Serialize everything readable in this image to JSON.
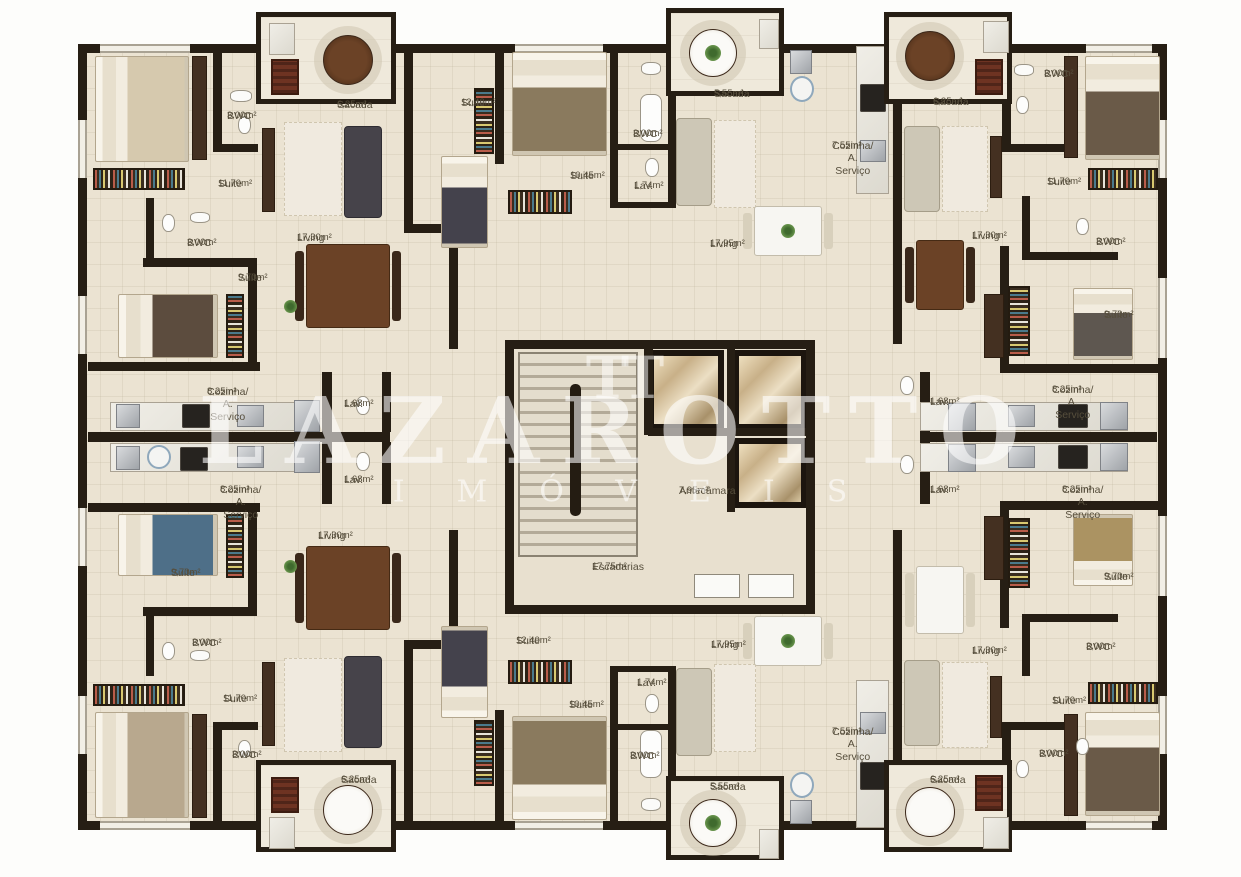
{
  "watermark": {
    "logo": "TT",
    "brand": "LAZAROTTO",
    "sub": "IMÓVEIS"
  },
  "rooms": [
    {
      "label": "BWC",
      "area": "3,00m²"
    },
    {
      "label": "Sacada",
      "area": "6,25m²"
    },
    {
      "label": "Suite",
      "area": "11,70m²"
    },
    {
      "label": "BWC",
      "area": "3,00m²"
    },
    {
      "label": "Suite",
      "area": "9,70m²"
    },
    {
      "label": "Living",
      "area": "17,30m²"
    },
    {
      "label": "Cozinha/ A. Serviço",
      "area": "8,25m²"
    },
    {
      "label": "Lav.",
      "area": "1,68m²"
    },
    {
      "label": "Suite",
      "area": "12,40m²"
    },
    {
      "label": "BWC",
      "area": "3,00m²"
    },
    {
      "label": "Suite",
      "area": "10,45m²"
    },
    {
      "label": "Lav.",
      "area": "1,74m²"
    },
    {
      "label": "Sacada",
      "area": "5,55m²"
    },
    {
      "label": "Living",
      "area": "17,95m²"
    },
    {
      "label": "Cozinha/ A. Serviço",
      "area": "7,55m²"
    },
    {
      "label": "Sacada",
      "area": "6,25m²"
    },
    {
      "label": "BWC",
      "area": "3,00m²"
    },
    {
      "label": "Suite",
      "area": "11,70m²"
    },
    {
      "label": "Living",
      "area": "17,30m²"
    },
    {
      "label": "BWC",
      "area": "3,00m²"
    },
    {
      "label": "Suite",
      "area": "9,70m²"
    },
    {
      "label": "Cozinha/ A. Serviço",
      "area": "8,25m²"
    },
    {
      "label": "Lav.",
      "area": "1,68m²"
    },
    {
      "label": "Cozinha/ A. Serviço",
      "area": "8,25m²"
    },
    {
      "label": "Lav.",
      "area": "1,68m²"
    },
    {
      "label": "Suite",
      "area": "9,70m²"
    },
    {
      "label": "Living",
      "area": "17,30m²"
    },
    {
      "label": "BWC",
      "area": "3,00m²"
    },
    {
      "label": "Suite",
      "area": "11,70m²"
    },
    {
      "label": "BWC",
      "area": "3,00m²"
    },
    {
      "label": "Sacada",
      "area": "6,25m²"
    },
    {
      "label": "Suite",
      "area": "12,40m²"
    },
    {
      "label": "Living",
      "area": "17,95m²"
    },
    {
      "label": "Suite",
      "area": "10,45m²"
    },
    {
      "label": "Lav.",
      "area": "1,74m²"
    },
    {
      "label": "BWC",
      "area": "3,00m²"
    },
    {
      "label": "Sacada",
      "area": "5,55m²"
    },
    {
      "label": "Cozinha/ A. Serviço",
      "area": "7,55m²"
    },
    {
      "label": "Cozinha/ A. Serviço",
      "area": "8,25m²"
    },
    {
      "label": "Lav.",
      "area": "1,68m²"
    },
    {
      "label": "Suite",
      "area": "9,70m²"
    },
    {
      "label": "Living",
      "area": "17,30m²"
    },
    {
      "label": "BWC",
      "area": "3,00m²"
    },
    {
      "label": "Suite",
      "area": "11,70m²"
    },
    {
      "label": "BWC",
      "area": "3,00m²"
    },
    {
      "label": "Sacada",
      "area": "6,25m²"
    },
    {
      "label": "Antecâmara",
      "area": "7,95m²"
    },
    {
      "label": "Escadarias",
      "area": "17,75m²"
    }
  ]
}
